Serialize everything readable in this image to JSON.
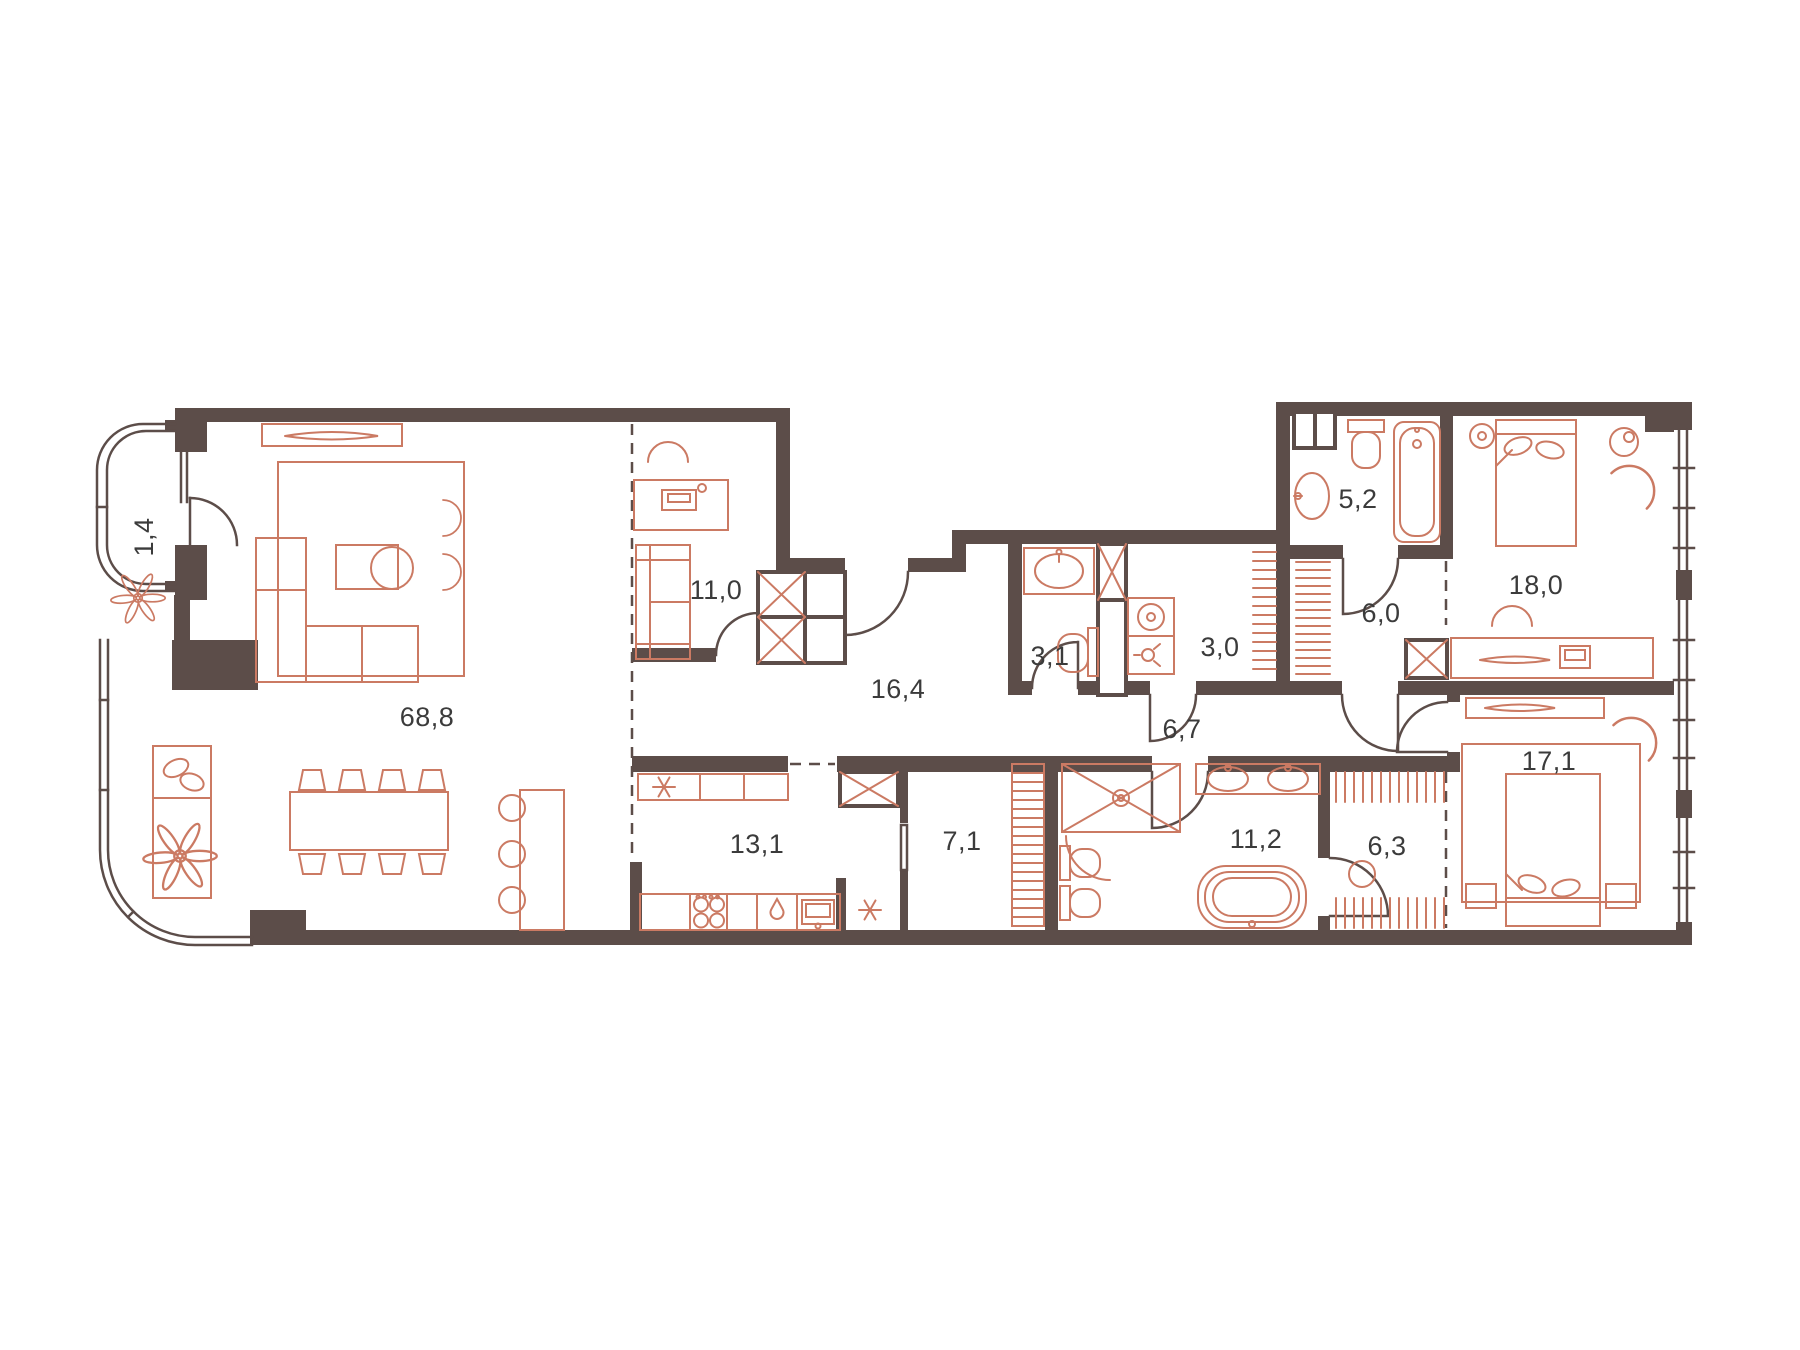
{
  "plan": {
    "type": "apartment-floor-plan",
    "units": "m2-labels-with-comma-decimals"
  },
  "colors": {
    "wall": "#5C4D49",
    "furniture": "#CB7A63",
    "text": "#3B3B3B",
    "background": "#FFFFFF"
  },
  "rooms": [
    {
      "name": "balcony",
      "area": "1,4"
    },
    {
      "name": "living-room",
      "area": "68,8"
    },
    {
      "name": "study",
      "area": "11,0"
    },
    {
      "name": "entrance-hall",
      "area": "16,4"
    },
    {
      "name": "wc",
      "area": "3,1"
    },
    {
      "name": "laundry",
      "area": "3,0"
    },
    {
      "name": "corridor",
      "area": "6,7"
    },
    {
      "name": "bathroom",
      "area": "5,2"
    },
    {
      "name": "hall",
      "area": "6,0"
    },
    {
      "name": "bedroom-1",
      "area": "18,0"
    },
    {
      "name": "bedroom-2",
      "area": "17,1"
    },
    {
      "name": "kitchen",
      "area": "13,1"
    },
    {
      "name": "pantry",
      "area": "7,1"
    },
    {
      "name": "master-bathroom",
      "area": "11,2"
    },
    {
      "name": "wardrobe",
      "area": "6,3"
    }
  ]
}
